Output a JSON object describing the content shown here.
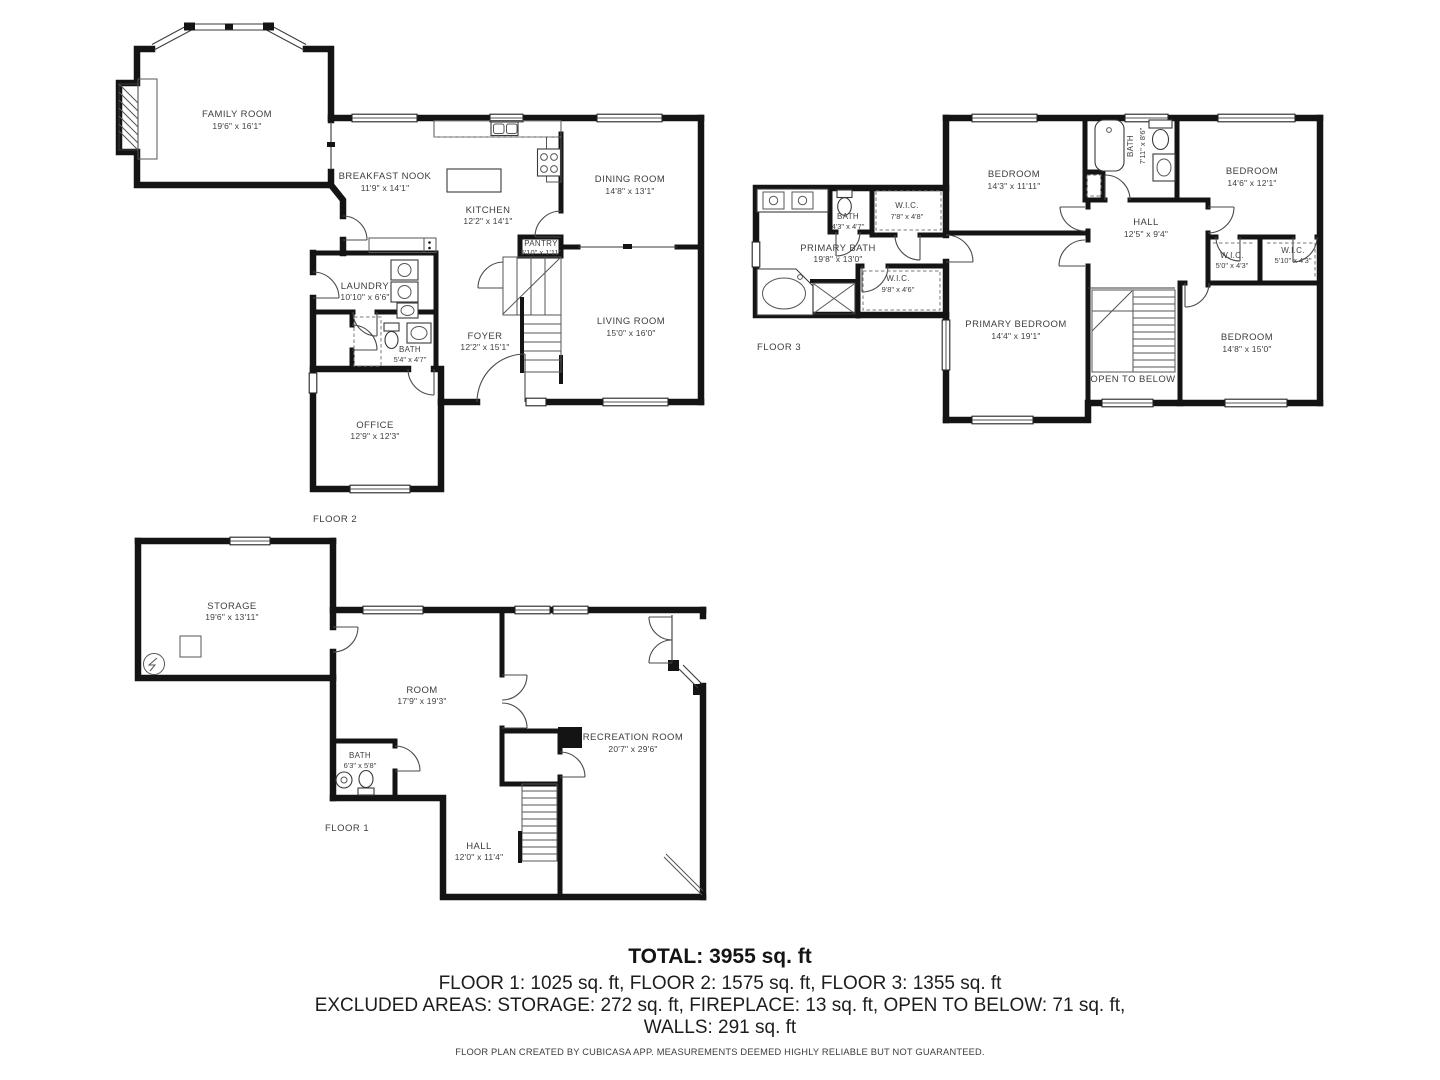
{
  "floor2": {
    "label": "FLOOR 2",
    "rooms": {
      "family": {
        "name": "FAMILY ROOM",
        "dims": "19'6\" x 16'1\""
      },
      "breakfast": {
        "name": "BREAKFAST NOOK",
        "dims": "11'9\" x 14'1\""
      },
      "kitchen": {
        "name": "KITCHEN",
        "dims": "12'2\" x 14'1\""
      },
      "dining": {
        "name": "DINING ROOM",
        "dims": "14'8\" x 13'1\""
      },
      "pantry": {
        "name": "PANTRY",
        "dims": "5'10\" x 1'11\""
      },
      "laundry": {
        "name": "LAUNDRY",
        "dims": "10'10\" x 6'6\""
      },
      "bath": {
        "name": "BATH",
        "dims": "5'4\" x 4'7\""
      },
      "foyer": {
        "name": "FOYER",
        "dims": "12'2\" x 15'1\""
      },
      "living": {
        "name": "LIVING ROOM",
        "dims": "15'0\" x 16'0\""
      },
      "office": {
        "name": "OFFICE",
        "dims": "12'9\" x 12'3\""
      }
    }
  },
  "floor3": {
    "label": "FLOOR 3",
    "rooms": {
      "bedroom_nw": {
        "name": "BEDROOM",
        "dims": "14'3\" x 11'11\""
      },
      "bath_top": {
        "name": "BATH",
        "dims": "7'11\" x 8'6\""
      },
      "bedroom_ne": {
        "name": "BEDROOM",
        "dims": "14'6\" x 12'1\""
      },
      "hall": {
        "name": "HALL",
        "dims": "12'5\" x 9'4\""
      },
      "wic_left": {
        "name": "W.I.C.",
        "dims": "5'0\" x 4'3\""
      },
      "wic_right": {
        "name": "W.I.C.",
        "dims": "5'10\" x 4'3\""
      },
      "bath_small": {
        "name": "BATH",
        "dims": "4'3\" x 4'7\""
      },
      "wic_top": {
        "name": "W.I.C.",
        "dims": "7'8\" x 4'8\""
      },
      "primary_bath": {
        "name": "PRIMARY BATH",
        "dims": "19'8\" x 13'0\""
      },
      "wic_bottom": {
        "name": "W.I.C.",
        "dims": "9'8\" x 4'6\""
      },
      "primary_bedroom": {
        "name": "PRIMARY BEDROOM",
        "dims": "14'4\" x 19'1\""
      },
      "open_below": {
        "name": "OPEN TO BELOW"
      },
      "bedroom_se": {
        "name": "BEDROOM",
        "dims": "14'8\" x 15'0\""
      }
    }
  },
  "floor1": {
    "label": "FLOOR 1",
    "rooms": {
      "storage": {
        "name": "STORAGE",
        "dims": "19'6\" x 13'11\""
      },
      "room": {
        "name": "ROOM",
        "dims": "17'9\" x 19'3\""
      },
      "bath": {
        "name": "BATH",
        "dims": "6'3\" x 5'8\""
      },
      "hall": {
        "name": "HALL",
        "dims": "12'0\" x 11'4\""
      },
      "recreation": {
        "name": "RECREATION ROOM",
        "dims": "20'7\" x 29'6\""
      }
    }
  },
  "summary": {
    "total": "TOTAL: 3955 sq. ft",
    "floors": "FLOOR 1: 1025 sq. ft, FLOOR 2: 1575 sq. ft, FLOOR 3: 1355 sq. ft",
    "excluded": "EXCLUDED AREAS: STORAGE: 272 sq. ft, FIREPLACE: 13 sq. ft, OPEN TO BELOW: 71 sq. ft,",
    "walls": "WALLS: 291 sq. ft",
    "disclaimer": "FLOOR PLAN CREATED BY CUBICASA APP. MEASUREMENTS DEEMED HIGHLY RELIABLE BUT NOT GUARANTEED."
  },
  "colors": {
    "background": "#ffffff",
    "walls": "#141414",
    "labels": "#3e3e3e"
  }
}
